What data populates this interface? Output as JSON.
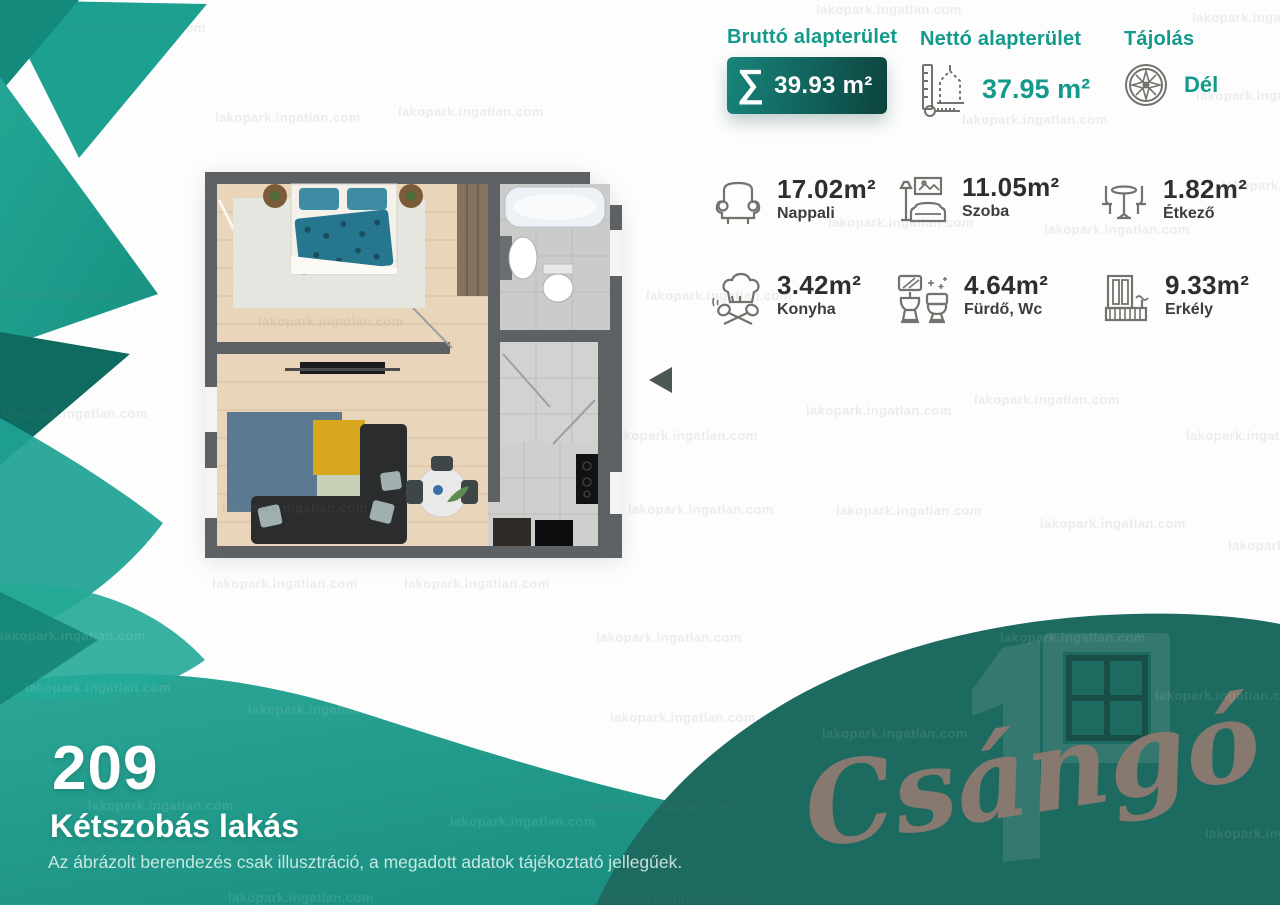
{
  "watermark": "lakopark.ingatlan.com",
  "header": {
    "gross": {
      "label": "Bruttó alapterület",
      "sigma": "∑",
      "value": "39.93 m²"
    },
    "net": {
      "label": "Nettó alapterület",
      "value": "37.95 m²"
    },
    "orientation": {
      "label": "Tájolás",
      "value": "Dél"
    }
  },
  "rooms": [
    {
      "icon": "armchair-icon",
      "area": "17.02m²",
      "name": "Nappali"
    },
    {
      "icon": "sofa-lamp-icon",
      "area": "11.05m²",
      "name": "Szoba"
    },
    {
      "icon": "dining-set-icon",
      "area": "1.82m²",
      "name": "Étkező"
    },
    {
      "icon": "chef-hat-icon",
      "area": "3.42m²",
      "name": "Konyha"
    },
    {
      "icon": "bathroom-icon",
      "area": "4.64m²",
      "name": "Fürdő, Wc"
    },
    {
      "icon": "balcony-icon",
      "area": "9.33m²",
      "name": "Erkély"
    }
  ],
  "footer": {
    "apartment_number": "209",
    "apartment_type": "Kétszobás lakás",
    "disclaimer": "Az ábrázolt berendezés csak illusztráció, a megadott adatok tájékoztató jellegűek."
  },
  "brand": {
    "logo_number": "10",
    "logo_script": "Csángó"
  },
  "colors": {
    "accent_teal": "#149a8b",
    "band_teal": "#1f9d8d",
    "dark_wave": "#1d6a60",
    "script_brown": "#8d7a70"
  }
}
